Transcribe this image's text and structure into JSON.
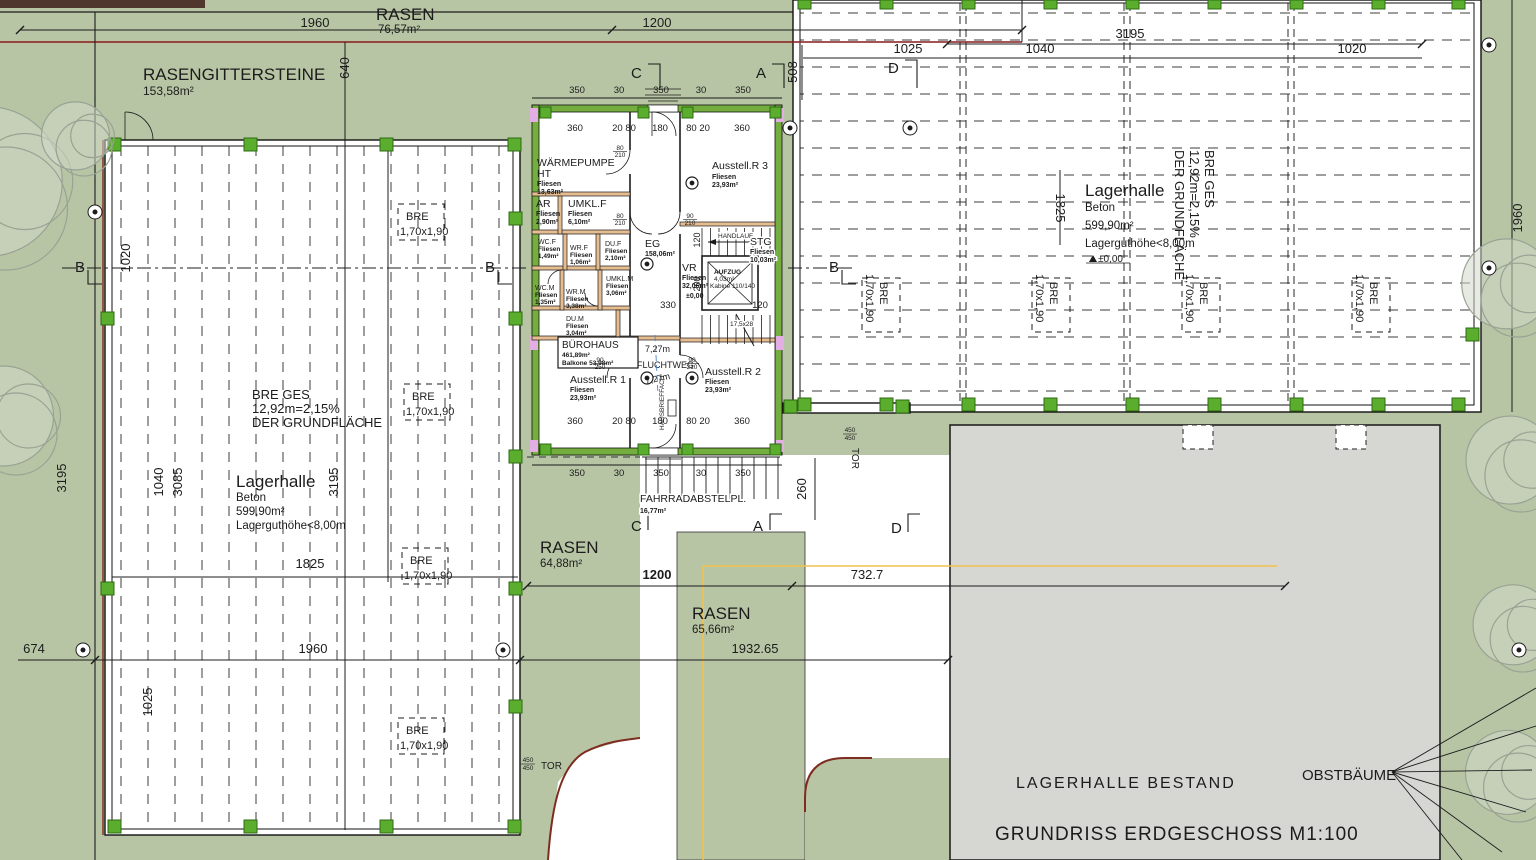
{
  "title": {
    "main": "GRUNDRISS ERDGESCHOSS M1:100",
    "existing": "LAGERHALLE BESTAND",
    "trees": "OBSTBÄUME"
  },
  "areas": {
    "rasen_top": {
      "name": "RASEN",
      "area": "76,57m²"
    },
    "gitter": {
      "name": "RASENGITTERSTEINE",
      "area": "153,58m²"
    },
    "rasen_sw": {
      "name": "RASEN",
      "area": "64,88m²"
    },
    "rasen_s": {
      "name": "RASEN",
      "area": "65,66m²"
    },
    "fahrrad": {
      "name": "FAHRRADABSTELPL.",
      "area": "16,77m²"
    }
  },
  "hall_left": {
    "name": "Lagerhalle",
    "mat": "Beton",
    "area": "599,90m²",
    "note": "Lagerguthöhe<8,00m",
    "bre1": "BRE GES",
    "bre2": "12,92m=2,15%",
    "bre3": "DER GRUNDFLÄCHE"
  },
  "hall_right": {
    "name": "Lagerhalle",
    "mat": "Beton",
    "area": "599,90m²",
    "note": "Lagerguthöhe<8,00m",
    "bre1": "BRE GES",
    "bre2": "12,92m=2,15%",
    "bre3": "DER GRUNDFLÄCHE",
    "level": "±0,00"
  },
  "bre_box": {
    "l1": "BRE",
    "l2": "1,70x1,90"
  },
  "rooms": {
    "wp": {
      "n": "WÄRMEPUMPE",
      "n2": "HT",
      "f": "Fliesen",
      "a": "13,63m²"
    },
    "ar": {
      "n": "AR",
      "f": "Fliesen",
      "a": "2,90m²"
    },
    "umklf": {
      "n": "UMKL.F",
      "f": "Fliesen",
      "a": "6,10m²"
    },
    "wcf": {
      "n": "WC.F",
      "f": "Fliesen",
      "a": "1,49m²"
    },
    "wrf": {
      "n": "WR.F",
      "f": "Fliesen",
      "a": "1,06m²"
    },
    "duf": {
      "n": "DU.F",
      "f": "Fliesen",
      "a": "2,10m²"
    },
    "eg": {
      "n": "EG",
      "a": "158,06m²"
    },
    "vr": {
      "n": "VR",
      "f": "Fliesen",
      "a": "32,06m²",
      "level": "±0,00"
    },
    "aufzug": {
      "n": "AUFZUG",
      "a": "4,03m²",
      "k": "Kabine 110/140"
    },
    "stg": {
      "n": "STG",
      "f": "Fliesen",
      "a": "10,03m²",
      "steps": "17,5x28",
      "handlauf": "HANDLAUF"
    },
    "wcm": {
      "n": "WC.M",
      "f": "Fliesen",
      "a": "1,35m²"
    },
    "wrm": {
      "n": "WR.M",
      "f": "Fliesen",
      "a": "3,38m²"
    },
    "umklm": {
      "n": "UMKL.M",
      "f": "Fliesen",
      "a": "3,06m²"
    },
    "dum": {
      "n": "DU.M",
      "f": "Fliesen",
      "a": "3,04m²"
    },
    "buero": {
      "n": "BÜROHAUS",
      "a": "461,89m²",
      "b": "Balkone 53,98m²"
    },
    "a1": {
      "n": "Ausstell.R 1",
      "f": "Fliesen",
      "a": "23,93m²"
    },
    "a2": {
      "n": "Ausstell.R 2",
      "f": "Fliesen",
      "a": "23,93m²"
    },
    "a3": {
      "n": "Ausstell.R 3",
      "f": "Fliesen",
      "a": "23,93m²"
    }
  },
  "flucht": {
    "d1": "7,27m",
    "name": "FLUCHTWEG",
    "d2": "7,27m",
    "brief": "HAUSBRIEFFACH"
  },
  "tor": {
    "label": "TOR",
    "a": "450",
    "b": "450"
  },
  "sections": {
    "a": "A",
    "b": "B",
    "c": "C",
    "d": "D"
  },
  "dims": {
    "d30": "30",
    "d120": "120",
    "d180": "180",
    "d200": "200",
    "d260": "260",
    "d330": "330",
    "d350": "350",
    "d360": "360",
    "d508": "508",
    "d640": "640",
    "d674": "674",
    "d1020": "1020",
    "d1025": "1025",
    "d1040": "1040",
    "d1200": "1200",
    "d1825": "1825",
    "d1960": "1960",
    "d2080": "20 80",
    "d8020": "80 20",
    "d3085": "3085",
    "d3195": "3195",
    "d7327": "732.7",
    "d193265": "1932.65",
    "d80": "80",
    "d90": "90",
    "d210": "210",
    "d250": "250"
  },
  "colors": {
    "ground": "#b8c5a5",
    "paper": "#ffffff",
    "existing": "#d6d6d3",
    "column": "#5bad2d",
    "wall_green": "#74ae3f",
    "wall_orange": "#e6bd90",
    "accent_pink": "#e3aee3",
    "curb_red": "#7e2c20",
    "boundary_red": "#8c1a1a",
    "guide_yellow": "#f2c14e",
    "escape_blue": "#4d86c8"
  }
}
